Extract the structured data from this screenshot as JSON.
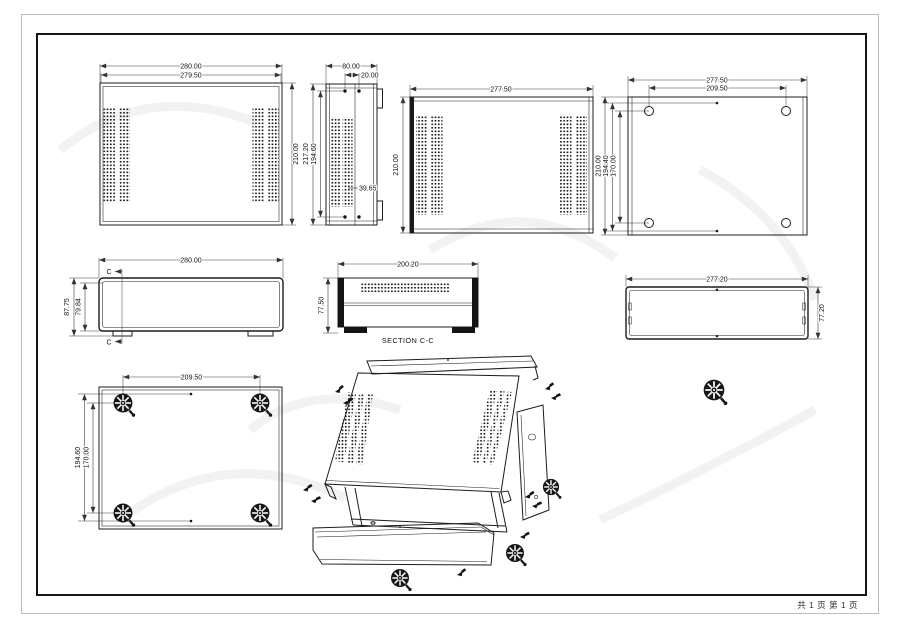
{
  "footer": {
    "page_info": "共 1 页  第 1 页"
  },
  "views": {
    "rear_panel": {
      "width_outer": "280.00",
      "width_inner": "279.50",
      "height": "210.00"
    },
    "side_panel": {
      "width": "80.00",
      "hole_offset": "20.00",
      "height_outer": "217.20",
      "height_inner": "194.60",
      "depth_note": "39.65"
    },
    "inner_panel": {
      "width": "277.50",
      "height": "210.00"
    },
    "base_plate": {
      "width": "277.50",
      "hole_span_width": "209.50",
      "height": "210.00",
      "slot_span_height": "194.40",
      "hole_span_height": "170.00"
    },
    "front_view": {
      "width": "280.00",
      "height_outer": "87.75",
      "height_inner": "79.84",
      "section_mark": "C"
    },
    "section_view": {
      "width": "200.20",
      "height": "77.50",
      "caption": "SECTION C-C"
    },
    "frame_view": {
      "width": "277.20",
      "height": "77.20"
    },
    "bottom_view": {
      "foot_span_width": "209.50",
      "dot_span_height": "194.60",
      "foot_span_height": "170.00"
    }
  }
}
